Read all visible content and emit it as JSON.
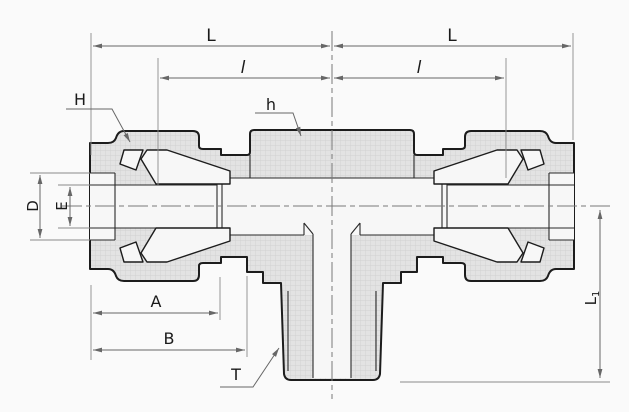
{
  "labels": {
    "overall_length_left": "L",
    "overall_length_right": "L",
    "tube_insertion_left": "l",
    "tube_insertion_right": "l",
    "nut_width_across_flats": "H",
    "body_width_across_flats": "h",
    "opening_diameter": "D",
    "bore_diameter": "E",
    "dim_A": "A",
    "dim_B": "B",
    "thread_size": "T",
    "branch_length_base": "L",
    "branch_length_subscript": "1"
  },
  "colors": {
    "outline": "#1c1c1c",
    "internal_line": "#2a2a2a",
    "dimension_line": "#676767",
    "label_text": "#1a1a1a",
    "section_fill": "#e3e3e3",
    "hatch_grid": "#cdcdcd",
    "cavity_fill": "#f7f7f7",
    "background": "#fafafa"
  }
}
